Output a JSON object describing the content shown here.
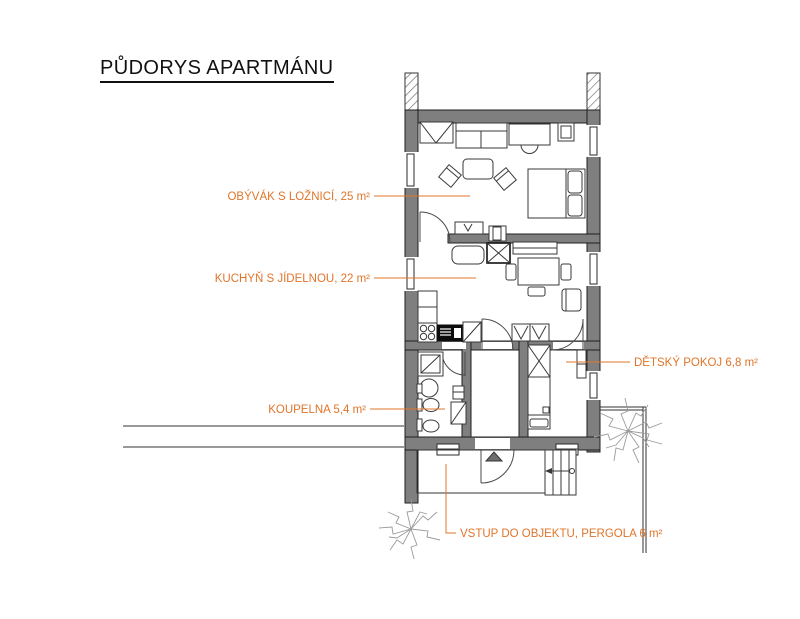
{
  "title": "PŮDORYS APARTMÁNU",
  "labels": {
    "living_room": "OBÝVÁK S LOŽNICÍ, 25 m²",
    "kitchen": "KUCHYŇ S JÍDELNOU, 22 m²",
    "bathroom": "KOUPELNA 5,4 m²",
    "kids_room": "DĚTSKÝ POKOJ 6,8 m²",
    "entrance": "VSTUP DO OBJEKTU, PERGOLA 6 m²"
  },
  "colors": {
    "label_orange": "#e0752a",
    "wall_gray": "#7f7f7f",
    "outline_black": "#1f1f1f"
  }
}
